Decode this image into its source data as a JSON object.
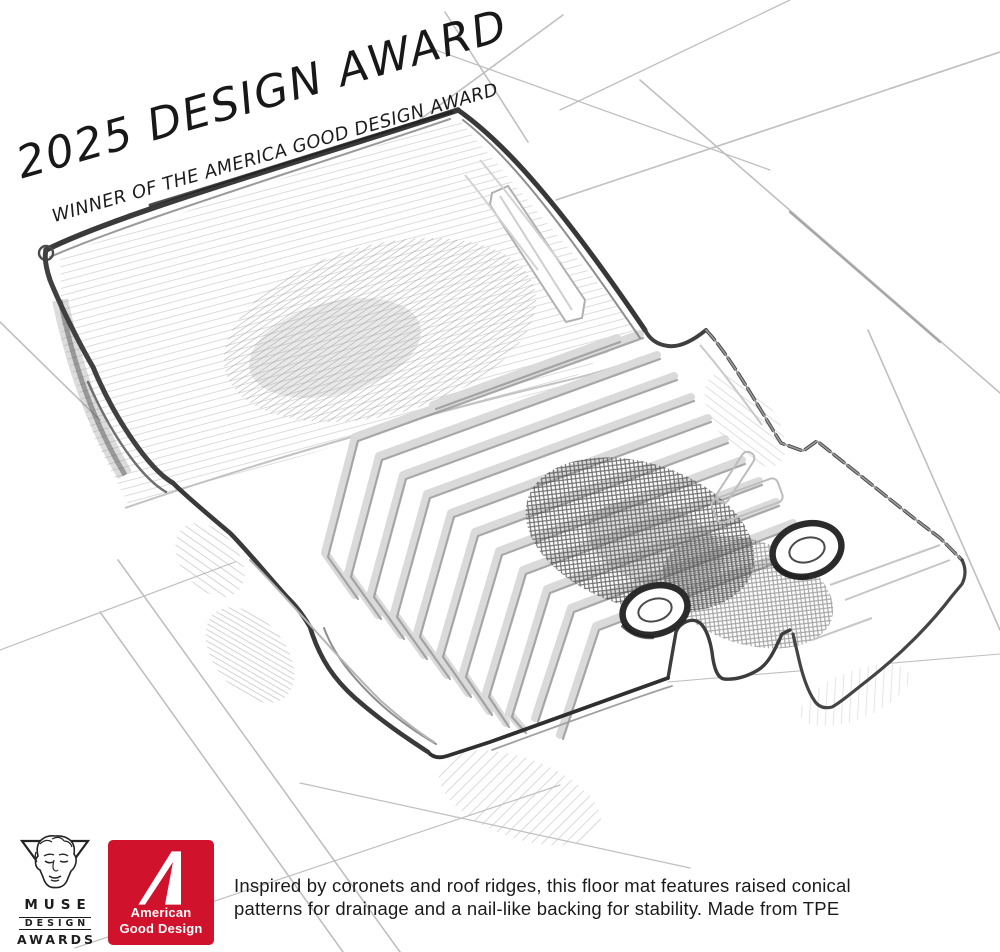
{
  "banner": {
    "title": "2025 DESIGN AWARD",
    "subtitle": "WINNER OF THE AMERICA GOOD DESIGN AWARD"
  },
  "badges": {
    "muse": {
      "name": "MUSE",
      "line2": "DESIGN",
      "line3": "AWARDS"
    },
    "american_good_design": {
      "line1": "American",
      "line2": "Good Design",
      "background_color": "#d0122c",
      "glyph_color": "#ffffff"
    }
  },
  "caption": {
    "line1": "Inspired by coronets and roof ridges, this floor mat features raised conical",
    "line2": "patterns for drainage and a nail-like backing for stability. Made from TPE"
  },
  "sketch": {
    "subject": "pencil concept sketch of a vehicle floor mat",
    "visible_features": "chevron ridge pattern, two grommet holes, raised back wall, perspective floor grid lines",
    "pencil_color": "#3a3a3a",
    "grommet_count": "2"
  }
}
